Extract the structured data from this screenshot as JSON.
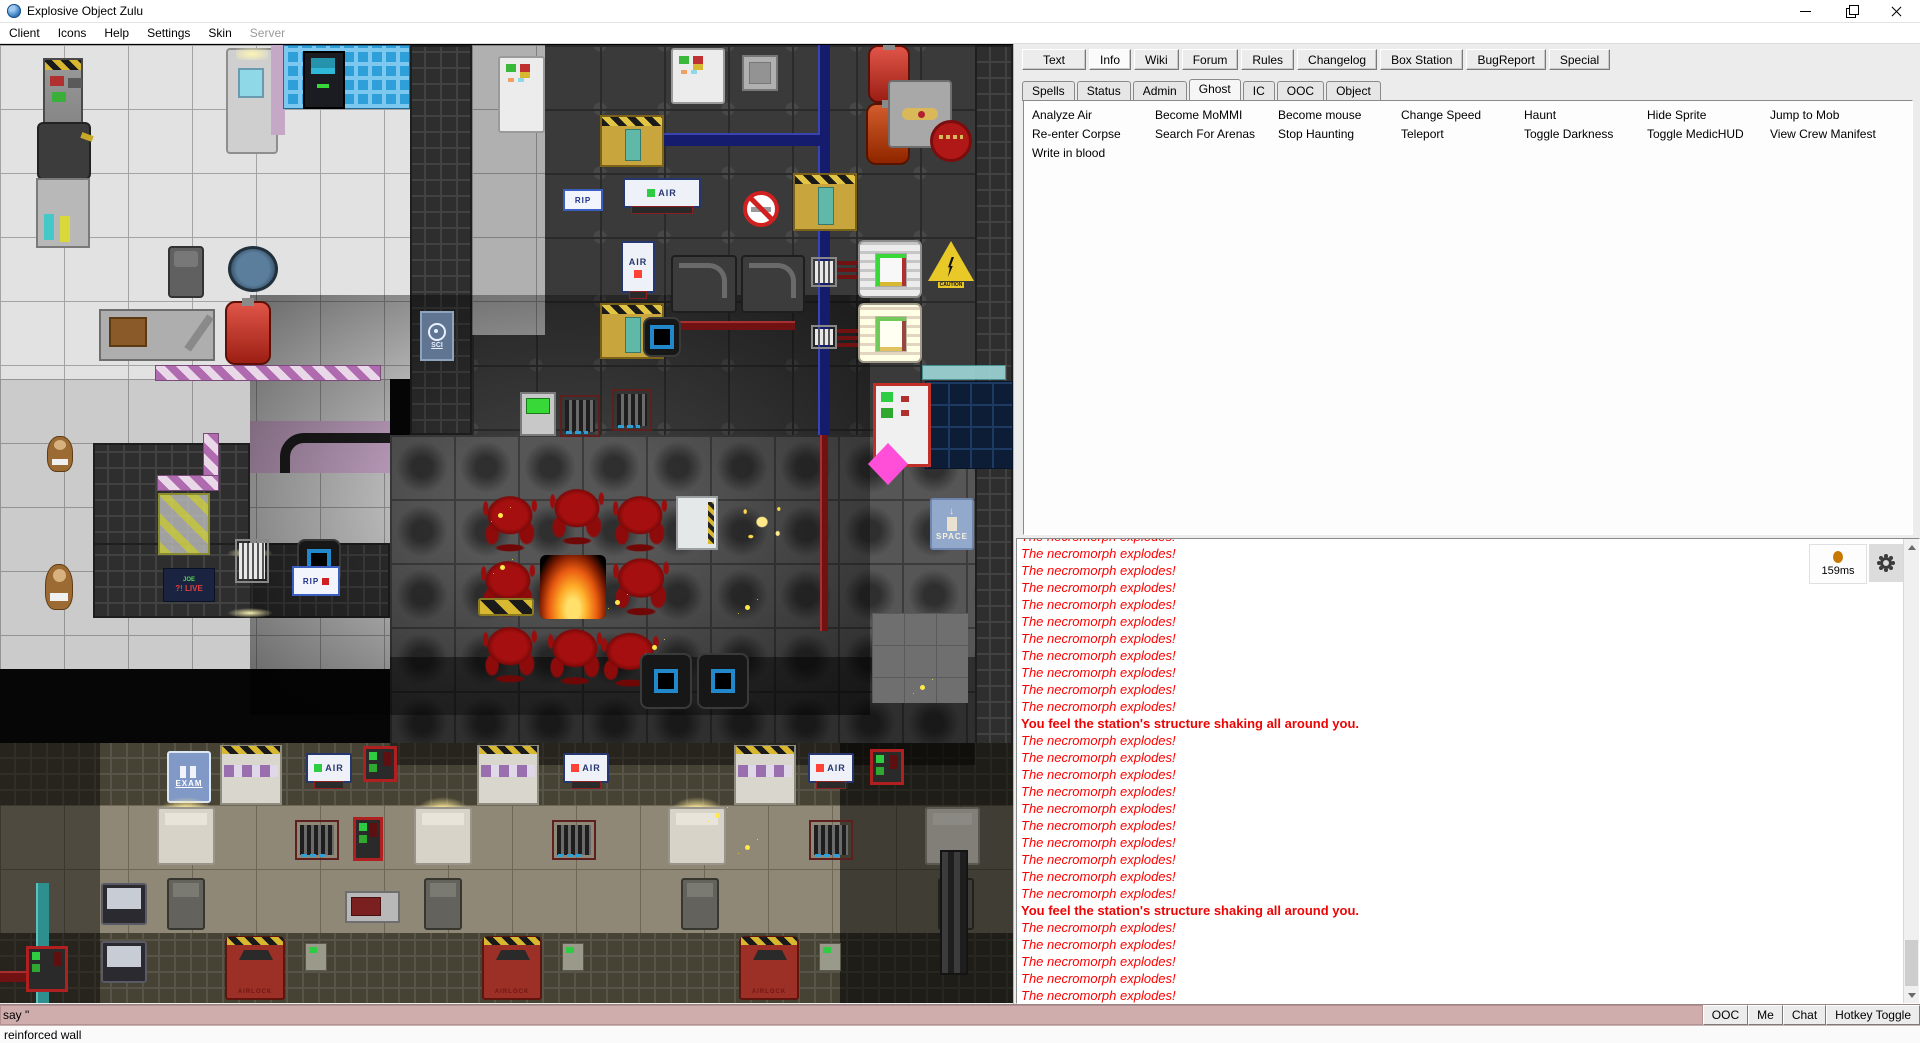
{
  "window": {
    "title": "Explosive Object Zulu"
  },
  "menu": {
    "items": [
      {
        "label": "Client"
      },
      {
        "label": "Icons"
      },
      {
        "label": "Help"
      },
      {
        "label": "Settings"
      },
      {
        "label": "Skin"
      },
      {
        "label": "Server",
        "disabled": true
      }
    ]
  },
  "toolbar_tabs": {
    "items": [
      {
        "label": "Text"
      },
      {
        "label": "Info",
        "active": true
      },
      {
        "label": "Wiki"
      },
      {
        "label": "Forum"
      },
      {
        "label": "Rules"
      },
      {
        "label": "Changelog"
      },
      {
        "label": "Box Station"
      },
      {
        "label": "BugReport"
      },
      {
        "label": "Special"
      }
    ]
  },
  "info_tabs": {
    "items": [
      {
        "label": "Spells"
      },
      {
        "label": "Status"
      },
      {
        "label": "Admin"
      },
      {
        "label": "Ghost",
        "active": true
      },
      {
        "label": "IC"
      },
      {
        "label": "OOC"
      },
      {
        "label": "Object"
      }
    ]
  },
  "commands": {
    "columns": [
      [
        "Analyze Air",
        "Re-enter Corpse",
        "Write in blood"
      ],
      [
        "Become MoMMI",
        "Search For Arenas"
      ],
      [
        "Become mouse",
        "Stop Haunting"
      ],
      [
        "Change Speed",
        "Teleport"
      ],
      [
        "Haunt",
        "Toggle Darkness"
      ],
      [
        "Hide Sprite",
        "Toggle MedicHUD"
      ],
      [
        "Jump to Mob",
        "View Crew Manifest"
      ]
    ]
  },
  "chat": {
    "ping": "159ms",
    "messages": [
      {
        "t": "The necromorph explodes!"
      },
      {
        "t": "The necromorph explodes!"
      },
      {
        "t": "The necromorph explodes!"
      },
      {
        "t": "The necromorph explodes!"
      },
      {
        "t": "The necromorph explodes!"
      },
      {
        "t": "The necromorph explodes!"
      },
      {
        "t": "The necromorph explodes!"
      },
      {
        "t": "The necromorph explodes!"
      },
      {
        "t": "The necromorph explodes!"
      },
      {
        "t": "The necromorph explodes!"
      },
      {
        "t": "The necromorph explodes!"
      },
      {
        "t": "You feel the station's structure shaking all around you.",
        "s": "bold"
      },
      {
        "t": "The necromorph explodes!"
      },
      {
        "t": "The necromorph explodes!"
      },
      {
        "t": "The necromorph explodes!"
      },
      {
        "t": "The necromorph explodes!"
      },
      {
        "t": "The necromorph explodes!"
      },
      {
        "t": "The necromorph explodes!"
      },
      {
        "t": "The necromorph explodes!"
      },
      {
        "t": "The necromorph explodes!"
      },
      {
        "t": "The necromorph explodes!"
      },
      {
        "t": "The necromorph explodes!"
      },
      {
        "t": "You feel the station's structure shaking all around you.",
        "s": "bold"
      },
      {
        "t": "The necromorph explodes!"
      },
      {
        "t": "The necromorph explodes!"
      },
      {
        "t": "The necromorph explodes!"
      },
      {
        "t": "The necromorph explodes!"
      },
      {
        "t": "The necromorph explodes!"
      }
    ]
  },
  "input": {
    "value": "say \""
  },
  "quick_buttons": [
    "OOC",
    "Me",
    "Chat",
    "Hotkey Toggle"
  ],
  "status_bar": {
    "text": "reinforced wall"
  },
  "map": {
    "labels": {
      "exam": "EXAM",
      "space": "SPACE",
      "sci": "SCI",
      "rip": "RIP",
      "air": "AIR",
      "airlock": "AIRLOCK",
      "caution": "CAUTION",
      "joe_top": "JOE",
      "joe_bottom": "?! LIVE"
    },
    "colors": {
      "blood": "#a50f0f",
      "fire": "#ffae2a",
      "hazard_yellow": "#d8b830",
      "pipe_blue": "#151c6e",
      "pipe_red": "#701212",
      "mauve": "#c5a8c5",
      "ping_dot": "#c87800",
      "chat_red": "#ff0000",
      "input_pink": "#cfadad"
    }
  }
}
